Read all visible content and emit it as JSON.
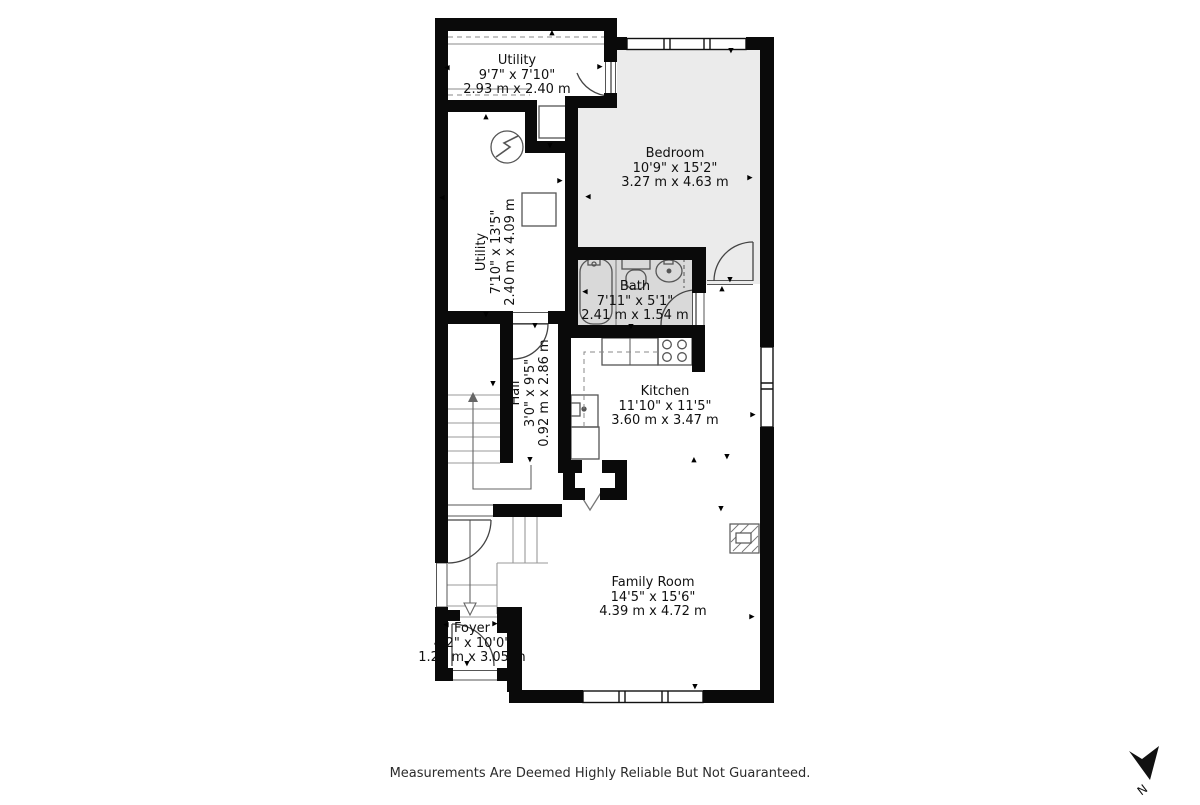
{
  "title": "Floor plan",
  "rooms": [
    {
      "id": "utility-top",
      "name": "Utility",
      "imperial": "9'7\" x 7'10\"",
      "metric": "2.93 m x 2.40 m"
    },
    {
      "id": "bedroom",
      "name": "Bedroom",
      "imperial": "10'9\" x 15'2\"",
      "metric": "3.27 m x 4.63 m"
    },
    {
      "id": "bath",
      "name": "Bath",
      "imperial": "7'11\" x 5'1\"",
      "metric": "2.41 m x 1.54 m"
    },
    {
      "id": "utility-left",
      "name": "Utility",
      "imperial": "7'10\" x 13'5\"",
      "metric": "2.40 m x 4.09 m"
    },
    {
      "id": "hall",
      "name": "Hall",
      "imperial": "3'0\" x 9'5\"",
      "metric": "0.92 m x 2.86 m"
    },
    {
      "id": "kitchen",
      "name": "Kitchen",
      "imperial": "11'10\" x 11'5\"",
      "metric": "3.60 m x 3.47 m"
    },
    {
      "id": "family-room",
      "name": "Family Room",
      "imperial": "14'5\" x 15'6\"",
      "metric": "4.39 m x 4.72 m"
    },
    {
      "id": "foyer",
      "name": "Foyer",
      "imperial": "4'2\" x 10'0\"",
      "metric": "1.27 m x 3.05 m"
    }
  ],
  "footer": {
    "disclaimer": "Measurements Are Deemed Highly Reliable But Not Guaranteed."
  },
  "compass": {
    "label": "N"
  },
  "colors": {
    "wall": "#0a0a0a",
    "bedroom_fill": "#ebebeb",
    "bath_fill": "#d9d9d9",
    "fixture_line": "#555555",
    "stair_line": "#999999"
  },
  "marker_glyphs": {
    "u": "▲",
    "d": "▼",
    "l": "◀",
    "r": "▶"
  },
  "markers": [
    {
      "x": 552,
      "y": 33,
      "d": "u"
    },
    {
      "x": 447,
      "y": 68,
      "d": "l"
    },
    {
      "x": 600,
      "y": 67,
      "d": "r"
    },
    {
      "x": 550,
      "y": 146,
      "d": "d"
    },
    {
      "x": 486,
      "y": 117,
      "d": "u"
    },
    {
      "x": 486,
      "y": 315,
      "d": "d"
    },
    {
      "x": 442,
      "y": 198,
      "d": "l"
    },
    {
      "x": 560,
      "y": 181,
      "d": "r"
    },
    {
      "x": 731,
      "y": 51,
      "d": "d"
    },
    {
      "x": 750,
      "y": 178,
      "d": "r"
    },
    {
      "x": 588,
      "y": 197,
      "d": "l"
    },
    {
      "x": 585,
      "y": 292,
      "d": "l"
    },
    {
      "x": 631,
      "y": 327,
      "d": "d"
    },
    {
      "x": 753,
      "y": 415,
      "d": "r"
    },
    {
      "x": 694,
      "y": 460,
      "d": "u"
    },
    {
      "x": 727,
      "y": 457,
      "d": "d"
    },
    {
      "x": 530,
      "y": 460,
      "d": "d"
    },
    {
      "x": 535,
      "y": 326,
      "d": "d"
    },
    {
      "x": 752,
      "y": 617,
      "d": "r"
    },
    {
      "x": 695,
      "y": 687,
      "d": "d"
    },
    {
      "x": 721,
      "y": 509,
      "d": "d"
    },
    {
      "x": 446,
      "y": 625,
      "d": "l"
    },
    {
      "x": 495,
      "y": 624,
      "d": "r"
    },
    {
      "x": 467,
      "y": 664,
      "d": "d"
    },
    {
      "x": 493,
      "y": 384,
      "d": "d"
    },
    {
      "x": 730,
      "y": 280,
      "d": "d"
    },
    {
      "x": 722,
      "y": 289,
      "d": "u"
    }
  ]
}
